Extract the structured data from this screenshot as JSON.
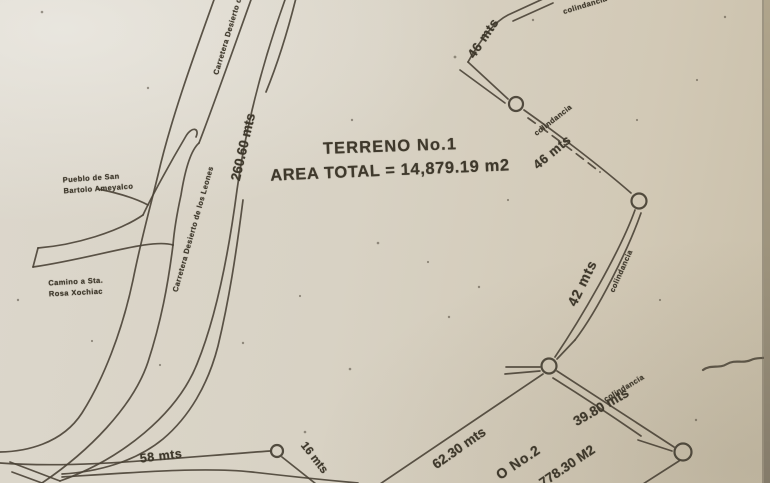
{
  "document": {
    "kind": "scanned land survey sketch",
    "parcel1": {
      "title": "TERRENO No.1",
      "area_total": "AREA TOTAL = 14,879.19 m2"
    },
    "parcel2": {
      "title_partial": "O No.2",
      "area_partial": "778.30 M2"
    }
  },
  "places": {
    "carretera_top": "Carretera Desierto de",
    "carretera_full": "Carretera Desierto de los Leones",
    "pueblo_line1": "Pueblo de San",
    "pueblo_line2": "Bartolo Ameyalco",
    "camino_line1": "Camino a Sta.",
    "camino_line2": "Rosa Xochiac"
  },
  "measurements": {
    "road_length": "260.60 mts",
    "seg_46a": "46 mts",
    "seg_46b": "46 mts",
    "seg_42": "42 mts",
    "seg_3980": "39.80 mts",
    "seg_6230": "62.30 mts",
    "seg_58": "58 mts",
    "seg_16": "16 mts"
  },
  "boundary_notes": {
    "colindancia_top": "colindancia",
    "colindancia_1": "colindancia",
    "colindancia_2": "colindancia",
    "colindancia_3": "colindancia"
  },
  "colors": {
    "paper": "#d8d2c4",
    "ink": "#4a4336",
    "pen_scribble": "#6ba3dc"
  }
}
